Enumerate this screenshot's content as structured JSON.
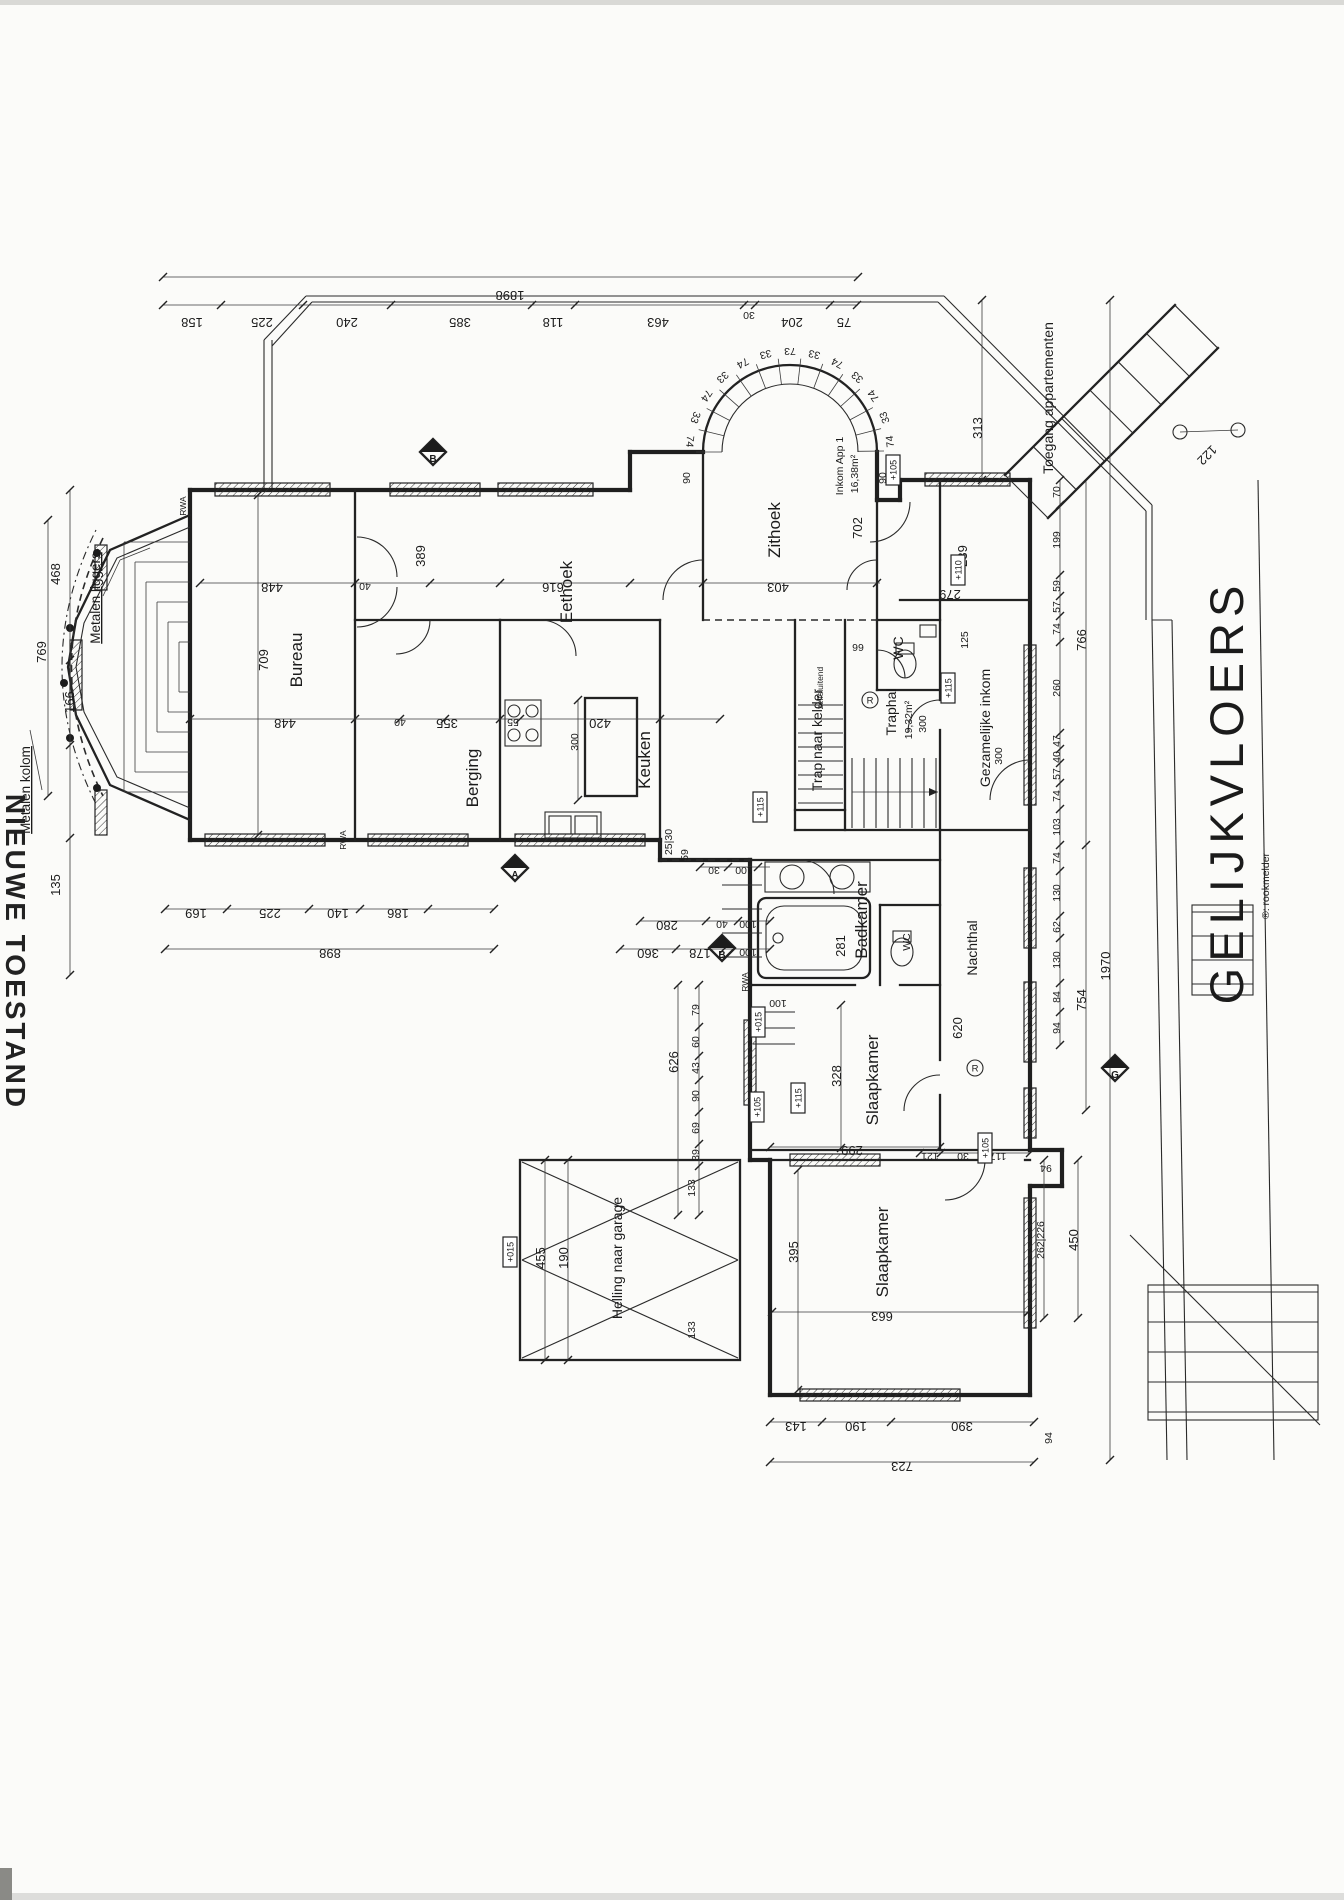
{
  "drawing": {
    "floor_title": "GELIJKVLOERS",
    "edge_title": "NIEUWE TOESTAND",
    "smoke_legend": "®: rookmelder"
  },
  "labels": [
    {
      "t": "Bureau",
      "x": 302,
      "y": 660,
      "r": "V",
      "c": "room",
      "n": "room-label-bureau"
    },
    {
      "t": "Eethoek",
      "x": 572,
      "y": 592,
      "r": "V",
      "c": "room",
      "n": "room-label-eethoek"
    },
    {
      "t": "Berging",
      "x": 478,
      "y": 778,
      "r": "V",
      "c": "room",
      "n": "room-label-berging"
    },
    {
      "t": "Keuken",
      "x": 650,
      "y": 760,
      "r": "V",
      "c": "room",
      "n": "room-label-keuken"
    },
    {
      "t": "Zithoek",
      "x": 780,
      "y": 530,
      "r": "V",
      "c": "room",
      "n": "room-label-zithoek"
    },
    {
      "t": "Badkamer",
      "x": 867,
      "y": 920,
      "r": "V",
      "c": "room",
      "n": "room-label-badkamer"
    },
    {
      "t": "Nachthal",
      "x": 977,
      "y": 948,
      "r": "V",
      "c": "roomS",
      "n": "room-label-nachthal"
    },
    {
      "t": "Slaapkamer",
      "x": 878,
      "y": 1080,
      "r": "V",
      "c": "room",
      "n": "room-label-slaapkamer-1"
    },
    {
      "t": "Slaapkamer",
      "x": 888,
      "y": 1252,
      "r": "V",
      "c": "room",
      "n": "room-label-slaapkamer-2"
    },
    {
      "t": "Helling naar garage",
      "x": 622,
      "y": 1258,
      "r": "V",
      "c": "roomS",
      "n": "room-label-helling"
    },
    {
      "t": "Gezamelijke inkom",
      "x": 990,
      "y": 728,
      "r": "V",
      "c": "roomS",
      "n": "room-label-gezamelijke-inkom"
    },
    {
      "t": "Trap naar kelder",
      "x": 822,
      "y": 740,
      "r": "V",
      "c": "roomS",
      "n": "room-label-trap-kelder"
    },
    {
      "t": "Traphal",
      "x": 896,
      "y": 712,
      "r": "V",
      "c": "roomS",
      "n": "room-label-traphal"
    },
    {
      "t": "19,32m²",
      "x": 912,
      "y": 720,
      "r": "V",
      "c": "dimS",
      "n": "area-traphal"
    },
    {
      "t": "300",
      "x": 926,
      "y": 724,
      "r": "V",
      "c": "dimS",
      "n": "dim"
    },
    {
      "t": "Inkom App 1",
      "x": 843,
      "y": 466,
      "r": "V",
      "c": "dimS",
      "n": "room-label-inkom-app1"
    },
    {
      "t": "16,38m²",
      "x": 858,
      "y": 474,
      "r": "V",
      "c": "dimS",
      "n": "area-inkom-app1"
    },
    {
      "t": "WC",
      "x": 903,
      "y": 648,
      "r": "V",
      "c": "roomS",
      "n": "room-label-wc-1"
    },
    {
      "t": "WC",
      "x": 910,
      "y": 942,
      "r": "V",
      "c": "dimS",
      "n": "room-label-wc-2"
    },
    {
      "t": "Toegang appartementen",
      "x": 1053,
      "y": 398,
      "r": "V",
      "c": "roomS",
      "n": "label-toegang-appartementen"
    },
    {
      "t": "zelfsluitend",
      "x": 823,
      "y": 688,
      "r": "V",
      "c": "tiny",
      "n": "label-zelfsluitend"
    },
    {
      "t": "1898",
      "x": 510,
      "y": 291,
      "r": "U"
    },
    {
      "t": "158",
      "x": 192,
      "y": 318,
      "r": "U"
    },
    {
      "t": "225",
      "x": 262,
      "y": 318,
      "r": "U"
    },
    {
      "t": "240",
      "x": 347,
      "y": 318,
      "r": "U"
    },
    {
      "t": "385",
      "x": 460,
      "y": 318,
      "r": "U"
    },
    {
      "t": "118",
      "x": 553,
      "y": 318,
      "r": "U"
    },
    {
      "t": "463",
      "x": 658,
      "y": 318,
      "r": "U"
    },
    {
      "t": "30",
      "x": 749,
      "y": 312,
      "r": "U",
      "c": "dimS"
    },
    {
      "t": "204",
      "x": 792,
      "y": 318,
      "r": "U"
    },
    {
      "t": "75",
      "x": 844,
      "y": 318,
      "r": "U"
    },
    {
      "t": "468",
      "x": 60,
      "y": 574,
      "r": "V"
    },
    {
      "t": "769",
      "x": 46,
      "y": 652,
      "r": "V"
    },
    {
      "t": "166",
      "x": 74,
      "y": 702,
      "r": "V"
    },
    {
      "t": "135",
      "x": 60,
      "y": 885,
      "r": "V"
    },
    {
      "t": "Metalen liggers",
      "x": 100,
      "y": 598,
      "r": "V",
      "c": "note",
      "n": "label-metalen-liggers"
    },
    {
      "t": "Metalen kolom",
      "x": 30,
      "y": 790,
      "r": "V",
      "c": "note",
      "n": "label-metalen-kolom"
    },
    {
      "t": "448",
      "x": 272,
      "y": 583,
      "r": "U"
    },
    {
      "t": "40",
      "x": 365,
      "y": 583,
      "r": "U",
      "c": "dimS"
    },
    {
      "t": "389",
      "x": 425,
      "y": 556,
      "r": "V"
    },
    {
      "t": "616",
      "x": 553,
      "y": 583,
      "r": "U"
    },
    {
      "t": "403",
      "x": 778,
      "y": 583,
      "r": "U"
    },
    {
      "t": "448",
      "x": 285,
      "y": 719,
      "r": "U"
    },
    {
      "t": "40",
      "x": 400,
      "y": 719,
      "r": "U",
      "c": "dimS"
    },
    {
      "t": "355",
      "x": 447,
      "y": 719,
      "r": "U"
    },
    {
      "t": "55",
      "x": 513,
      "y": 719,
      "r": "U",
      "c": "dimS"
    },
    {
      "t": "420",
      "x": 600,
      "y": 719,
      "r": "U"
    },
    {
      "t": "709",
      "x": 268,
      "y": 660,
      "r": "V"
    },
    {
      "t": "169",
      "x": 196,
      "y": 909,
      "r": "U"
    },
    {
      "t": "225",
      "x": 270,
      "y": 909,
      "r": "U"
    },
    {
      "t": "140",
      "x": 338,
      "y": 909,
      "r": "U"
    },
    {
      "t": "186",
      "x": 398,
      "y": 909,
      "r": "U"
    },
    {
      "t": "898",
      "x": 330,
      "y": 949,
      "r": "U"
    },
    {
      "t": "300",
      "x": 578,
      "y": 742,
      "r": "V",
      "c": "dimS"
    },
    {
      "t": "25|30",
      "x": 672,
      "y": 842,
      "r": "V",
      "c": "dimS"
    },
    {
      "t": "59",
      "x": 688,
      "y": 855,
      "r": "V",
      "c": "dimS"
    },
    {
      "t": "30",
      "x": 714,
      "y": 867,
      "r": "U",
      "c": "dimS"
    },
    {
      "t": "100",
      "x": 744,
      "y": 867,
      "r": "U",
      "c": "dimS"
    },
    {
      "t": "280",
      "x": 667,
      "y": 921,
      "r": "U"
    },
    {
      "t": "40",
      "x": 722,
      "y": 921,
      "r": "U",
      "c": "dimS"
    },
    {
      "t": "100",
      "x": 748,
      "y": 921,
      "r": "U",
      "c": "dimS"
    },
    {
      "t": "360",
      "x": 648,
      "y": 949,
      "r": "U"
    },
    {
      "t": "178",
      "x": 700,
      "y": 949,
      "r": "U"
    },
    {
      "t": "100",
      "x": 748,
      "y": 949,
      "r": "U",
      "c": "dimS"
    },
    {
      "t": "66",
      "x": 858,
      "y": 644,
      "r": "U",
      "c": "dimS"
    },
    {
      "t": "300",
      "x": 1002,
      "y": 756,
      "r": "V",
      "c": "dimS"
    },
    {
      "t": "239",
      "x": 967,
      "y": 556,
      "r": "V"
    },
    {
      "t": "279",
      "x": 950,
      "y": 590,
      "r": "U"
    },
    {
      "t": "125",
      "x": 968,
      "y": 640,
      "r": "V",
      "c": "dimS"
    },
    {
      "t": "313",
      "x": 982,
      "y": 428,
      "r": "V"
    },
    {
      "t": "122",
      "x": 1204,
      "y": 452,
      "r": "D"
    },
    {
      "t": "702",
      "x": 862,
      "y": 528,
      "r": "V"
    },
    {
      "t": "90",
      "x": 690,
      "y": 478,
      "r": "V",
      "c": "dimS"
    },
    {
      "t": "90",
      "x": 886,
      "y": 478,
      "r": "V",
      "c": "dimS"
    },
    {
      "t": "281",
      "x": 845,
      "y": 946,
      "r": "V"
    },
    {
      "t": "620",
      "x": 962,
      "y": 1028,
      "r": "V"
    },
    {
      "t": "328",
      "x": 841,
      "y": 1076,
      "r": "V"
    },
    {
      "t": "299",
      "x": 852,
      "y": 1146,
      "r": "U"
    },
    {
      "t": "395",
      "x": 798,
      "y": 1252,
      "r": "V"
    },
    {
      "t": "663",
      "x": 882,
      "y": 1312,
      "r": "U"
    },
    {
      "t": "100",
      "x": 778,
      "y": 1000,
      "r": "U",
      "c": "dimS"
    },
    {
      "t": "121",
      "x": 930,
      "y": 1153,
      "r": "U",
      "c": "dimS"
    },
    {
      "t": "30",
      "x": 963,
      "y": 1153,
      "r": "U",
      "c": "dimS"
    },
    {
      "t": "117",
      "x": 998,
      "y": 1153,
      "r": "U",
      "c": "dimS"
    },
    {
      "t": "626",
      "x": 678,
      "y": 1062,
      "r": "V"
    },
    {
      "t": "79",
      "x": 699,
      "y": 1010,
      "r": "V",
      "c": "dimS"
    },
    {
      "t": "60",
      "x": 699,
      "y": 1042,
      "r": "V",
      "c": "dimS"
    },
    {
      "t": "43",
      "x": 699,
      "y": 1068,
      "r": "V",
      "c": "dimS"
    },
    {
      "t": "90",
      "x": 699,
      "y": 1096,
      "r": "V",
      "c": "dimS"
    },
    {
      "t": "69",
      "x": 699,
      "y": 1128,
      "r": "V",
      "c": "dimS"
    },
    {
      "t": "39",
      "x": 699,
      "y": 1155,
      "r": "V",
      "c": "dimS"
    },
    {
      "t": "455",
      "x": 545,
      "y": 1258,
      "r": "V"
    },
    {
      "t": "190",
      "x": 568,
      "y": 1258,
      "r": "V"
    },
    {
      "t": "133",
      "x": 695,
      "y": 1188,
      "r": "V",
      "c": "dimS"
    },
    {
      "t": "133",
      "x": 695,
      "y": 1330,
      "r": "V",
      "c": "dimS"
    },
    {
      "t": "143",
      "x": 796,
      "y": 1422,
      "r": "U"
    },
    {
      "t": "190",
      "x": 856,
      "y": 1422,
      "r": "U"
    },
    {
      "t": "390",
      "x": 962,
      "y": 1422,
      "r": "U"
    },
    {
      "t": "723",
      "x": 902,
      "y": 1462,
      "r": "U"
    },
    {
      "t": "70",
      "x": 1060,
      "y": 492,
      "r": "V",
      "c": "dimS"
    },
    {
      "t": "199",
      "x": 1060,
      "y": 540,
      "r": "V",
      "c": "dimS"
    },
    {
      "t": "59",
      "x": 1060,
      "y": 586,
      "r": "V",
      "c": "dimS"
    },
    {
      "t": "57",
      "x": 1060,
      "y": 607,
      "r": "V",
      "c": "dimS"
    },
    {
      "t": "74",
      "x": 1060,
      "y": 629,
      "r": "V",
      "c": "dimS"
    },
    {
      "t": "260",
      "x": 1060,
      "y": 688,
      "r": "V",
      "c": "dimS"
    },
    {
      "t": "47",
      "x": 1060,
      "y": 741,
      "r": "V",
      "c": "dimS"
    },
    {
      "t": "40",
      "x": 1060,
      "y": 757,
      "r": "V",
      "c": "dimS"
    },
    {
      "t": "57",
      "x": 1060,
      "y": 774,
      "r": "V",
      "c": "dimS"
    },
    {
      "t": "74",
      "x": 1060,
      "y": 796,
      "r": "V",
      "c": "dimS"
    },
    {
      "t": "103",
      "x": 1060,
      "y": 827,
      "r": "V",
      "c": "dimS"
    },
    {
      "t": "74",
      "x": 1060,
      "y": 858,
      "r": "V",
      "c": "dimS"
    },
    {
      "t": "130",
      "x": 1060,
      "y": 893,
      "r": "V",
      "c": "dimS"
    },
    {
      "t": "62",
      "x": 1060,
      "y": 927,
      "r": "V",
      "c": "dimS"
    },
    {
      "t": "130",
      "x": 1060,
      "y": 960,
      "r": "V",
      "c": "dimS"
    },
    {
      "t": "84",
      "x": 1060,
      "y": 997,
      "r": "V",
      "c": "dimS"
    },
    {
      "t": "94",
      "x": 1060,
      "y": 1028,
      "r": "V",
      "c": "dimS"
    },
    {
      "t": "766",
      "x": 1086,
      "y": 640,
      "r": "V"
    },
    {
      "t": "754",
      "x": 1086,
      "y": 1000,
      "r": "V"
    },
    {
      "t": "1970",
      "x": 1110,
      "y": 966,
      "r": "V"
    },
    {
      "t": "450",
      "x": 1078,
      "y": 1240,
      "r": "V"
    },
    {
      "t": "262|226",
      "x": 1044,
      "y": 1240,
      "r": "V",
      "c": "dimS"
    },
    {
      "t": "94",
      "x": 1046,
      "y": 1165,
      "r": "U",
      "c": "dimS"
    },
    {
      "t": "94",
      "x": 1052,
      "y": 1438,
      "r": "V",
      "c": "dimS"
    },
    {
      "t": "RWA",
      "x": 186,
      "y": 506,
      "r": "V",
      "c": "tiny"
    },
    {
      "t": "RWA",
      "x": 346,
      "y": 840,
      "r": "V",
      "c": "tiny"
    },
    {
      "t": "RWA",
      "x": 748,
      "y": 982,
      "r": "V",
      "c": "tiny"
    },
    {
      "t": "GELIJKVLOERS",
      "x": 1243,
      "y": 792,
      "r": "V",
      "c": "title",
      "n": "page-title"
    },
    {
      "t": "®: rookmelder",
      "x": 1269,
      "y": 886,
      "r": "V",
      "c": "legend",
      "n": "smoke-legend"
    },
    {
      "t": "NIEUWE TOESTAND",
      "x": 6,
      "y": 952,
      "r": "W",
      "c": "edge",
      "n": "edge-title"
    }
  ],
  "level_boxes": [
    {
      "x": 893,
      "y": 470,
      "t": "+105"
    },
    {
      "x": 958,
      "y": 570,
      "t": "+110"
    },
    {
      "x": 948,
      "y": 688,
      "t": "+115"
    },
    {
      "x": 760,
      "y": 807,
      "t": "+115"
    },
    {
      "x": 758,
      "y": 1022,
      "t": "+015"
    },
    {
      "x": 757,
      "y": 1107,
      "t": "+105"
    },
    {
      "x": 798,
      "y": 1098,
      "t": "+115"
    },
    {
      "x": 510,
      "y": 1252,
      "t": "+015"
    },
    {
      "x": 985,
      "y": 1148,
      "t": "+105"
    }
  ],
  "arc": {
    "cx": 790,
    "cy": 452,
    "r_label": 104,
    "items": [
      {
        "t": "74",
        "a": 174
      },
      {
        "t": "33",
        "a": 160
      },
      {
        "t": "74",
        "a": 146
      },
      {
        "t": "33",
        "a": 132
      },
      {
        "t": "74",
        "a": 118
      },
      {
        "t": "33",
        "a": 104
      },
      {
        "t": "73",
        "a": 90
      },
      {
        "t": "33",
        "a": 76
      },
      {
        "t": "74",
        "a": 62
      },
      {
        "t": "33",
        "a": 48
      },
      {
        "t": "74",
        "a": 34
      },
      {
        "t": "33",
        "a": 20
      },
      {
        "t": "74",
        "a": 6
      }
    ]
  },
  "smoke_detectors": [
    {
      "x": 870,
      "y": 700
    },
    {
      "x": 975,
      "y": 1068
    }
  ],
  "section_markers": [
    {
      "x": 433,
      "y": 452,
      "t": "B"
    },
    {
      "x": 515,
      "y": 868,
      "t": "A"
    },
    {
      "x": 722,
      "y": 948,
      "t": "B"
    },
    {
      "x": 1115,
      "y": 1068,
      "t": "G"
    }
  ]
}
